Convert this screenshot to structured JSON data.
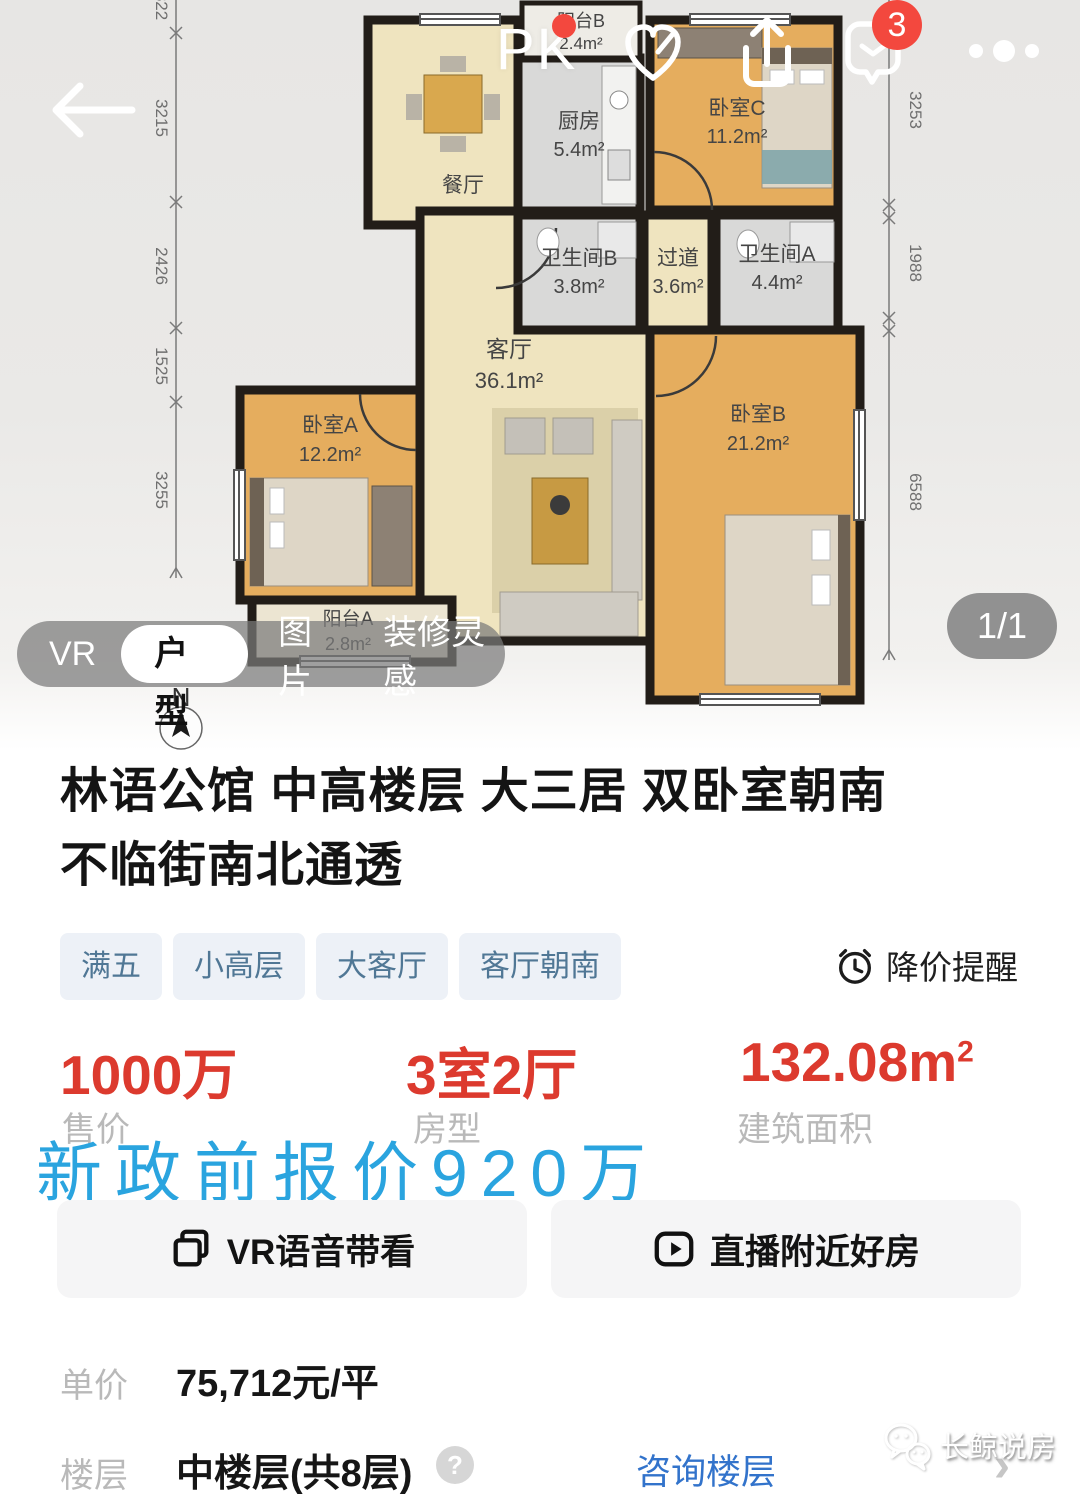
{
  "top_bar": {
    "pk_label": "PK",
    "badge_count": "3"
  },
  "floor_plan": {
    "rooms": {
      "balcony_b": {
        "name": "阳台B",
        "area": "2.4m²"
      },
      "kitchen": {
        "name": "厨房",
        "area": "5.4m²"
      },
      "bedroom_c": {
        "name": "卧室C",
        "area": "11.2m²"
      },
      "dining": {
        "name": "餐厅"
      },
      "bath_b": {
        "name": "卫生间B",
        "area": "3.8m²"
      },
      "hallway": {
        "name": "过道",
        "area": "3.6m²"
      },
      "bath_a": {
        "name": "卫生间A",
        "area": "4.4m²"
      },
      "living": {
        "name": "客厅",
        "area": "36.1m²"
      },
      "bedroom_a": {
        "name": "卧室A",
        "area": "12.2m²"
      },
      "bedroom_b": {
        "name": "卧室B",
        "area": "21.2m²"
      },
      "balcony_a": {
        "name": "阳台A",
        "area": "2.8m²"
      }
    },
    "dims_left": [
      "822",
      "3215",
      "2426",
      "1525",
      "3255"
    ],
    "dims_right": [
      "3253",
      "1988",
      "6588"
    ],
    "compass": "N"
  },
  "tabs": {
    "vr": "VR",
    "layout": "户型",
    "photos": "图片",
    "deco": "装修灵感"
  },
  "pager": "1/1",
  "listing": {
    "title_line1": "林语公馆 中高楼层 大三居 双卧室朝南",
    "title_line2": "不临街南北通透",
    "tags": [
      "满五",
      "小高层",
      "大客厅",
      "客厅朝南"
    ],
    "price_alert": "降价提醒",
    "stats": [
      {
        "value": "1000万",
        "label": "售价"
      },
      {
        "value": "3室2厅",
        "label": "房型"
      },
      {
        "value": "132.08m",
        "sup": "2",
        "label": "建筑面积"
      }
    ],
    "overlay_note": "新政前报价920万",
    "action_vr": "VR语音带看",
    "action_live": "直播附近好房",
    "unit_price_label": "单价",
    "unit_price_value": "75,712元/平",
    "floor_label": "楼层",
    "floor_value": "中楼层(共8层)",
    "floor_help": "?",
    "floor_link": "咨询楼层",
    "watermark": "长鲸说房"
  },
  "colors": {
    "price_red": "#dc3a2e",
    "link_blue": "#3273cb",
    "note_blue": "#2aa4df",
    "badge_red": "#f3483e",
    "tag_text": "#507795",
    "tag_bg": "#edf1f7"
  }
}
